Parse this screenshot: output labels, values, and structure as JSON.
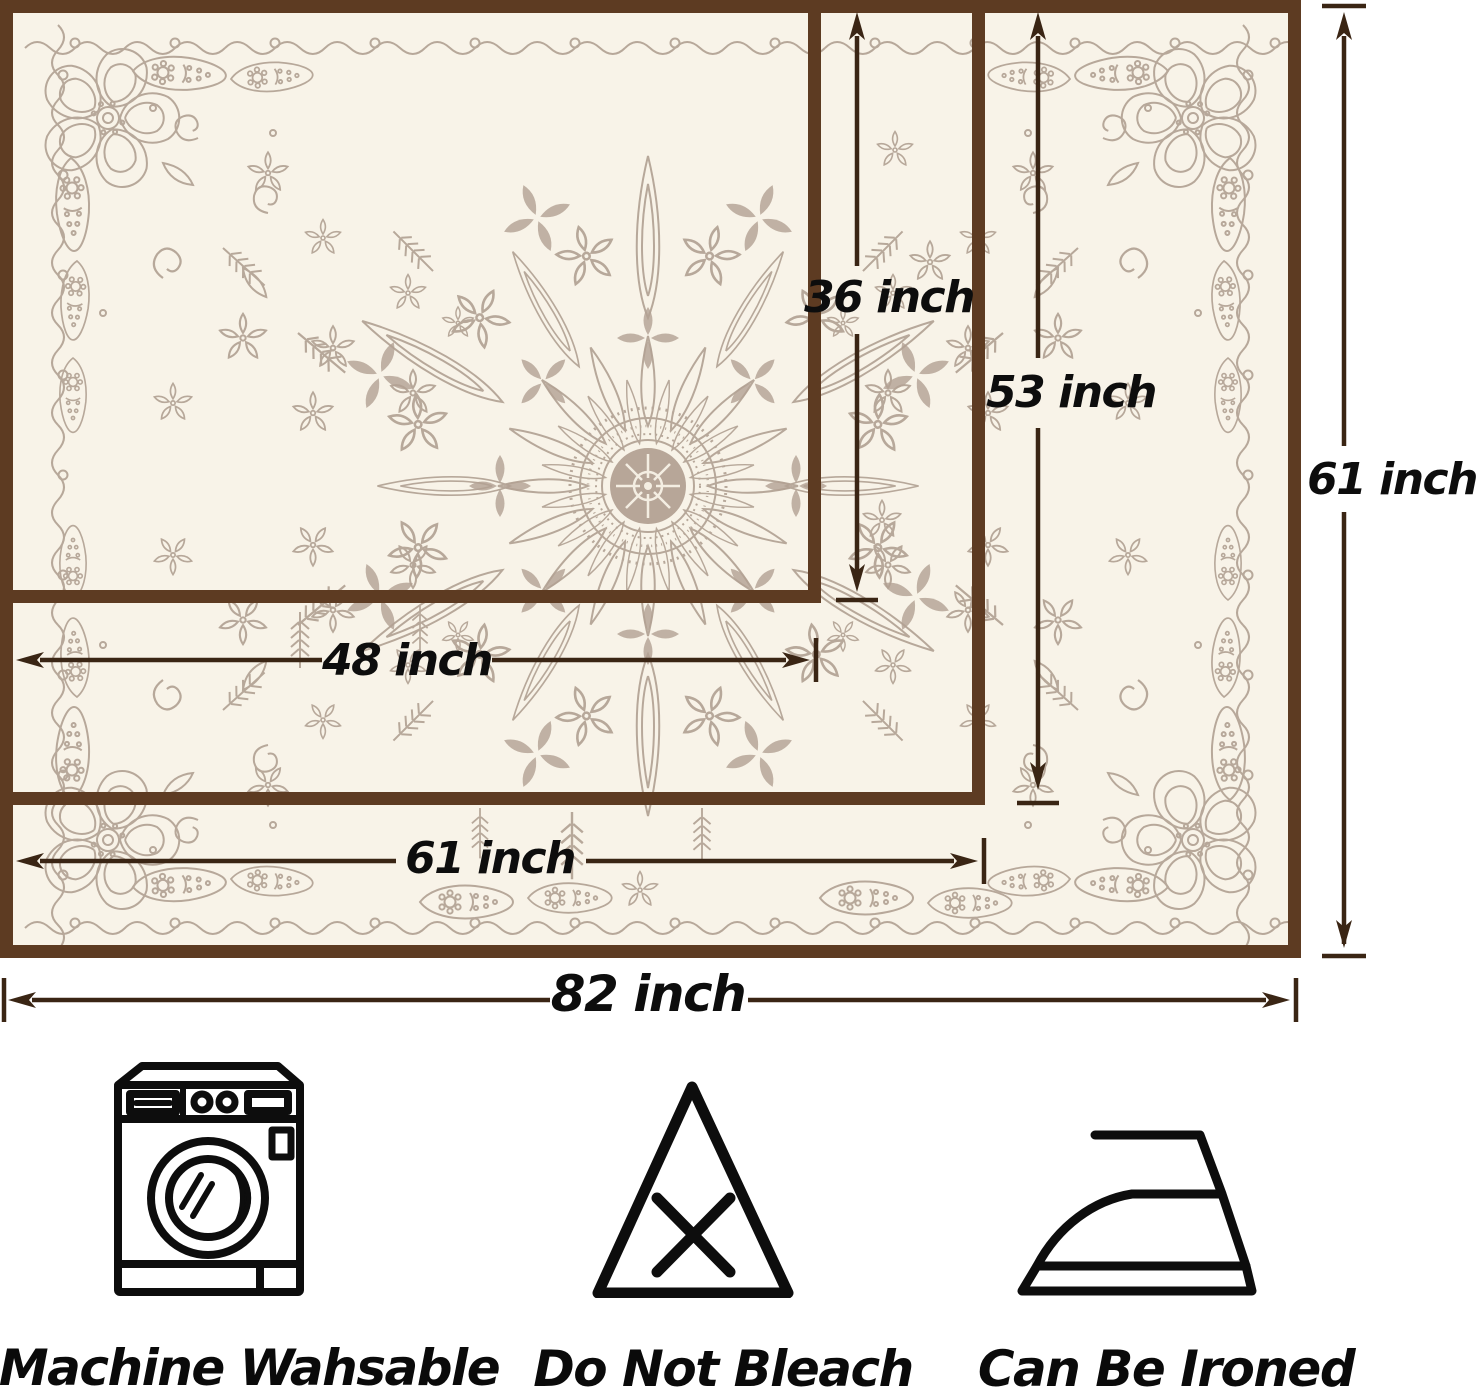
{
  "diagram": {
    "fill_color": "#f8f3e8",
    "border_color": "#5d3b22",
    "dimension_line_color": "#3a2514",
    "pattern_color": "#b7a89a",
    "labels": {
      "inner_height": "36 inch",
      "middle_height": "53 inch",
      "outer_height": "61 inch",
      "inner_width": "48 inch",
      "middle_width": "61 inch",
      "outer_width": "82 inch"
    },
    "sizes": [
      {
        "width": "48 inch",
        "height": "36 inch"
      },
      {
        "width": "61 inch",
        "height": "53 inch"
      },
      {
        "width": "82 inch",
        "height": "61 inch"
      }
    ]
  },
  "care": {
    "items": [
      {
        "icon": "washing-machine-icon",
        "label": "Machine Wahsable"
      },
      {
        "icon": "do-not-bleach-icon",
        "label": "Do Not Bleach"
      },
      {
        "icon": "iron-icon",
        "label": "Can Be Ironed"
      }
    ]
  }
}
